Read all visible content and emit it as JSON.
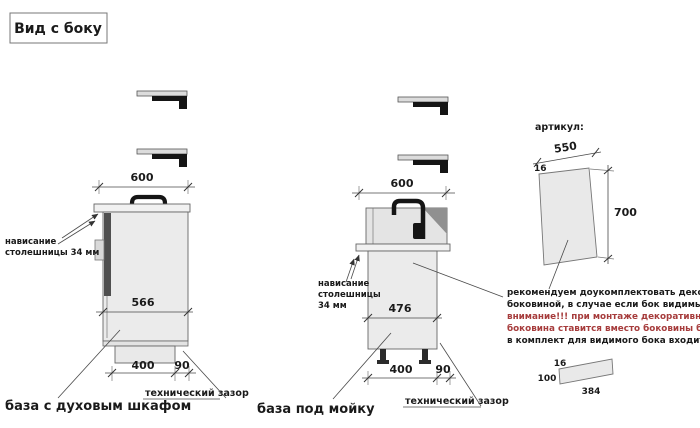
{
  "title": "Вид с боку",
  "colors": {
    "accent_red": "#a63c3c",
    "line": "#4a4a4a",
    "cabinet_fill": "#ebebeb"
  },
  "left": {
    "name": "база с духовым шкафом",
    "dims": {
      "top": "600",
      "inner": "566",
      "bottom": "400",
      "gap": "90"
    },
    "overhang_lines": [
      "нависание",
      "столешницы 34 мм"
    ],
    "tech_gap": "технический зазор"
  },
  "middle": {
    "name": "база под мойку",
    "dims": {
      "top": "600",
      "inner": "476",
      "bottom": "400",
      "gap": "90"
    },
    "overhang_lines": [
      "нависание",
      "столешницы",
      "34 мм"
    ],
    "tech_gap": "технический зазор"
  },
  "right": {
    "articul": "артикул:",
    "panel_dims": {
      "width": "550",
      "thickness": "16",
      "height": "700"
    },
    "note_lines": [
      {
        "text": "рекомендуем доукомплектовать декоративной",
        "color": "#1a1a1a"
      },
      {
        "text": "боковиной, в случае если бок видимый",
        "color": "#1a1a1a"
      },
      {
        "text": "внимание!!! при монтаже декоративная",
        "color": "#a63c3c"
      },
      {
        "text": "боковина ставится вместо боковины базы лдсп",
        "color": "#a63c3c"
      },
      {
        "text": "в комплект для видимого бока входит цоколь:",
        "color": "#1a1a1a"
      }
    ],
    "plinth_dims": {
      "thickness": "16",
      "height": "100",
      "width": "384"
    }
  }
}
